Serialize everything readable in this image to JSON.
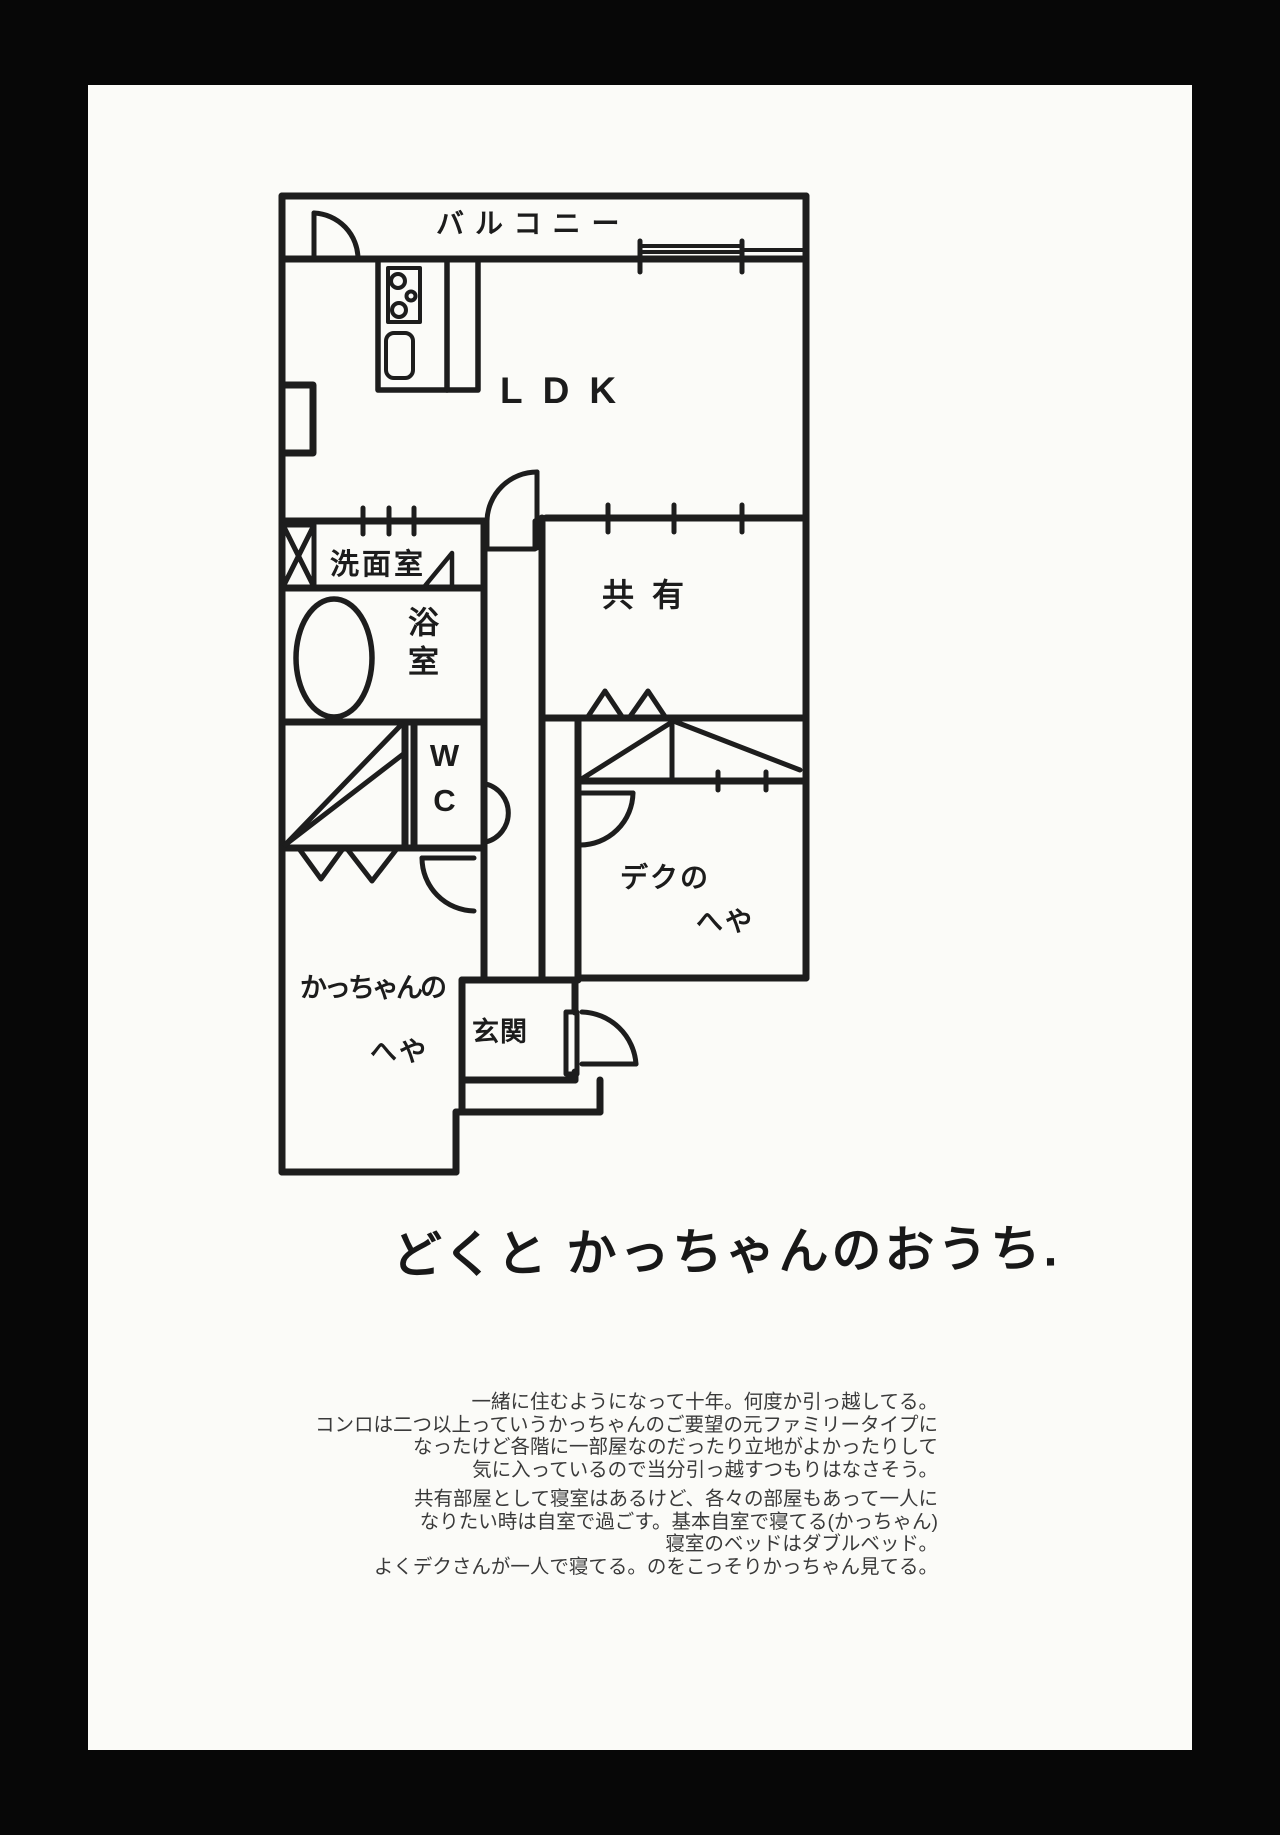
{
  "page": {
    "surround_color": "#070707",
    "paper_color": "#fbfbf8",
    "ink_color": "#1c1c1c",
    "print_text_color": "#3a3a3a"
  },
  "floor_plan": {
    "rooms": {
      "balcony": "バルコニー",
      "ldk": "LDK",
      "washroom": "洗面室",
      "bathroom": "浴室",
      "toilet": "WC",
      "shared": "共有",
      "deku_room_line1": "デクの",
      "deku_room_line2": "へや",
      "kacchan_room_line1": "かっちゃんの",
      "kacchan_room_line2": "へや",
      "entrance": "玄関"
    },
    "fixtures": [
      "stove",
      "kitchen-counter",
      "washing-machine",
      "bathtub",
      "sliding-window",
      "entrance-door"
    ]
  },
  "caption": {
    "title": "どくと かっちゃんのおうち."
  },
  "notes": {
    "paragraph1": [
      "一緒に住むようになって十年。何度か引っ越してる。",
      "コンロは二つ以上っていうかっちゃんのご要望の元ファミリータイプに",
      "なったけど各階に一部屋なのだったり立地がよかったりして",
      "気に入っているので当分引っ越すつもりはなさそう。"
    ],
    "paragraph2": [
      "共有部屋として寝室はあるけど、各々の部屋もあって一人に",
      "なりたい時は自室で過ごす。基本自室で寝てる(かっちゃん)",
      "寝室のベッドはダブルベッド。",
      "よくデクさんが一人で寝てる。のをこっそりかっちゃん見てる。"
    ]
  }
}
